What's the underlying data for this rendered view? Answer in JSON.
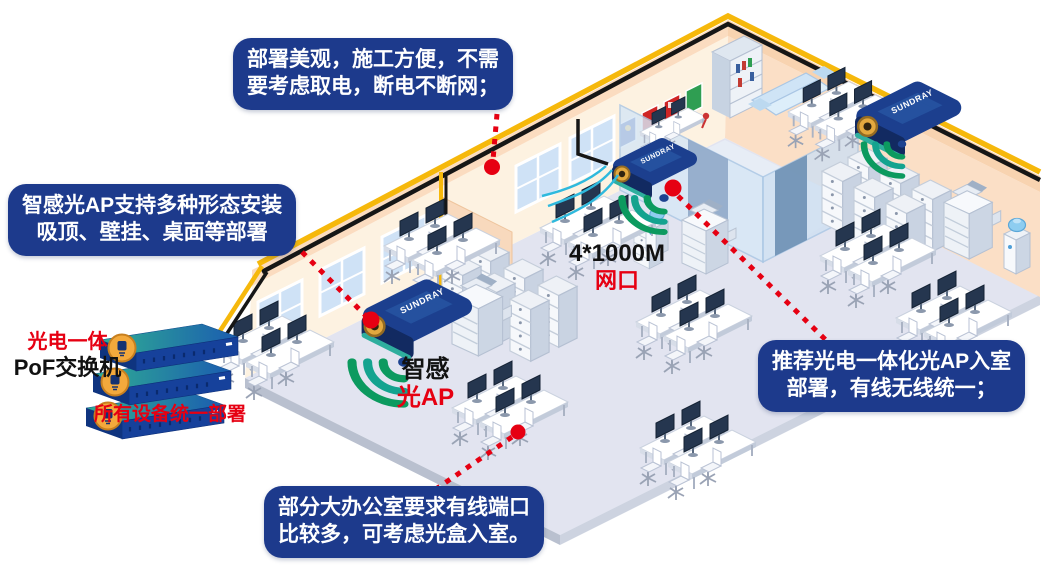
{
  "callouts": {
    "top": {
      "line1": "部署美观，施工方便，不需",
      "line2": "要考虑取电，断电不断网；"
    },
    "left": {
      "line1": "智感光AP支持多种形态安装",
      "line2": "吸顶、壁挂、桌面等部署"
    },
    "right": {
      "line1": "推荐光电一体化光AP入室",
      "line2": "部署，有线无线统一；"
    },
    "bottom": {
      "line1": "部分大办公室要求有线端口",
      "line2": "比较多，可考虑光盒入室。"
    }
  },
  "labels": {
    "pof_line1": "光电一体",
    "pof_line2": "PoF交换机",
    "deploy_caption": "所有设备统一部署",
    "port_count": "4*1000M",
    "port_type": "网口",
    "ap_name_black": "智感",
    "ap_name_red": "光AP",
    "device_brand": "SUNDRAY"
  },
  "colors": {
    "callout_bg": "#1d3a8c",
    "accent_red": "#e60012",
    "cable_yellow": "#f6b80b",
    "device_navy": "#1c3f8e",
    "wifi_green": "#0c9a5f",
    "wall_peach": "#fbdcc0",
    "floor": "#e2e4f0"
  }
}
